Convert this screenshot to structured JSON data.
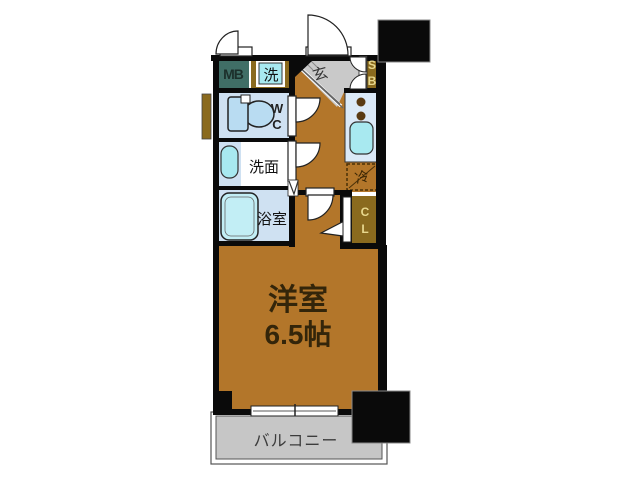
{
  "plan": {
    "rooms": {
      "meter_box": {
        "label": "MB"
      },
      "washer": {
        "label": "洗"
      },
      "entrance": {
        "label": "玄"
      },
      "shoe_box": {
        "line1": "S",
        "line2": "B"
      },
      "toilet": {
        "line1": "W",
        "line2": "C"
      },
      "washroom": {
        "label": "洗面"
      },
      "bathroom": {
        "label": "浴室"
      },
      "refrigerator": {
        "label": "冷"
      },
      "closet": {
        "line1": "C",
        "line2": "L"
      },
      "main_room": {
        "name": "洋室",
        "size": "6.5帖"
      },
      "balcony": {
        "label": "バルコニー"
      }
    },
    "colors": {
      "wall": "#0a0a0a",
      "floor_brown": "#b3762a",
      "box_brown": "#8a6a1e",
      "meter_box_teal": "#406e66",
      "water_blue": "#cfe1f2",
      "fixture_cyan": "#a8e9f0",
      "tub_cyan": "#c2eef5",
      "toilet_blue": "#b9dcf2",
      "counter_blue": "#dbe9f7",
      "genkan_gray": "#c9c9c9",
      "balcony_gray": "#c6c6c6",
      "burner_brown": "#5a3a12"
    }
  }
}
